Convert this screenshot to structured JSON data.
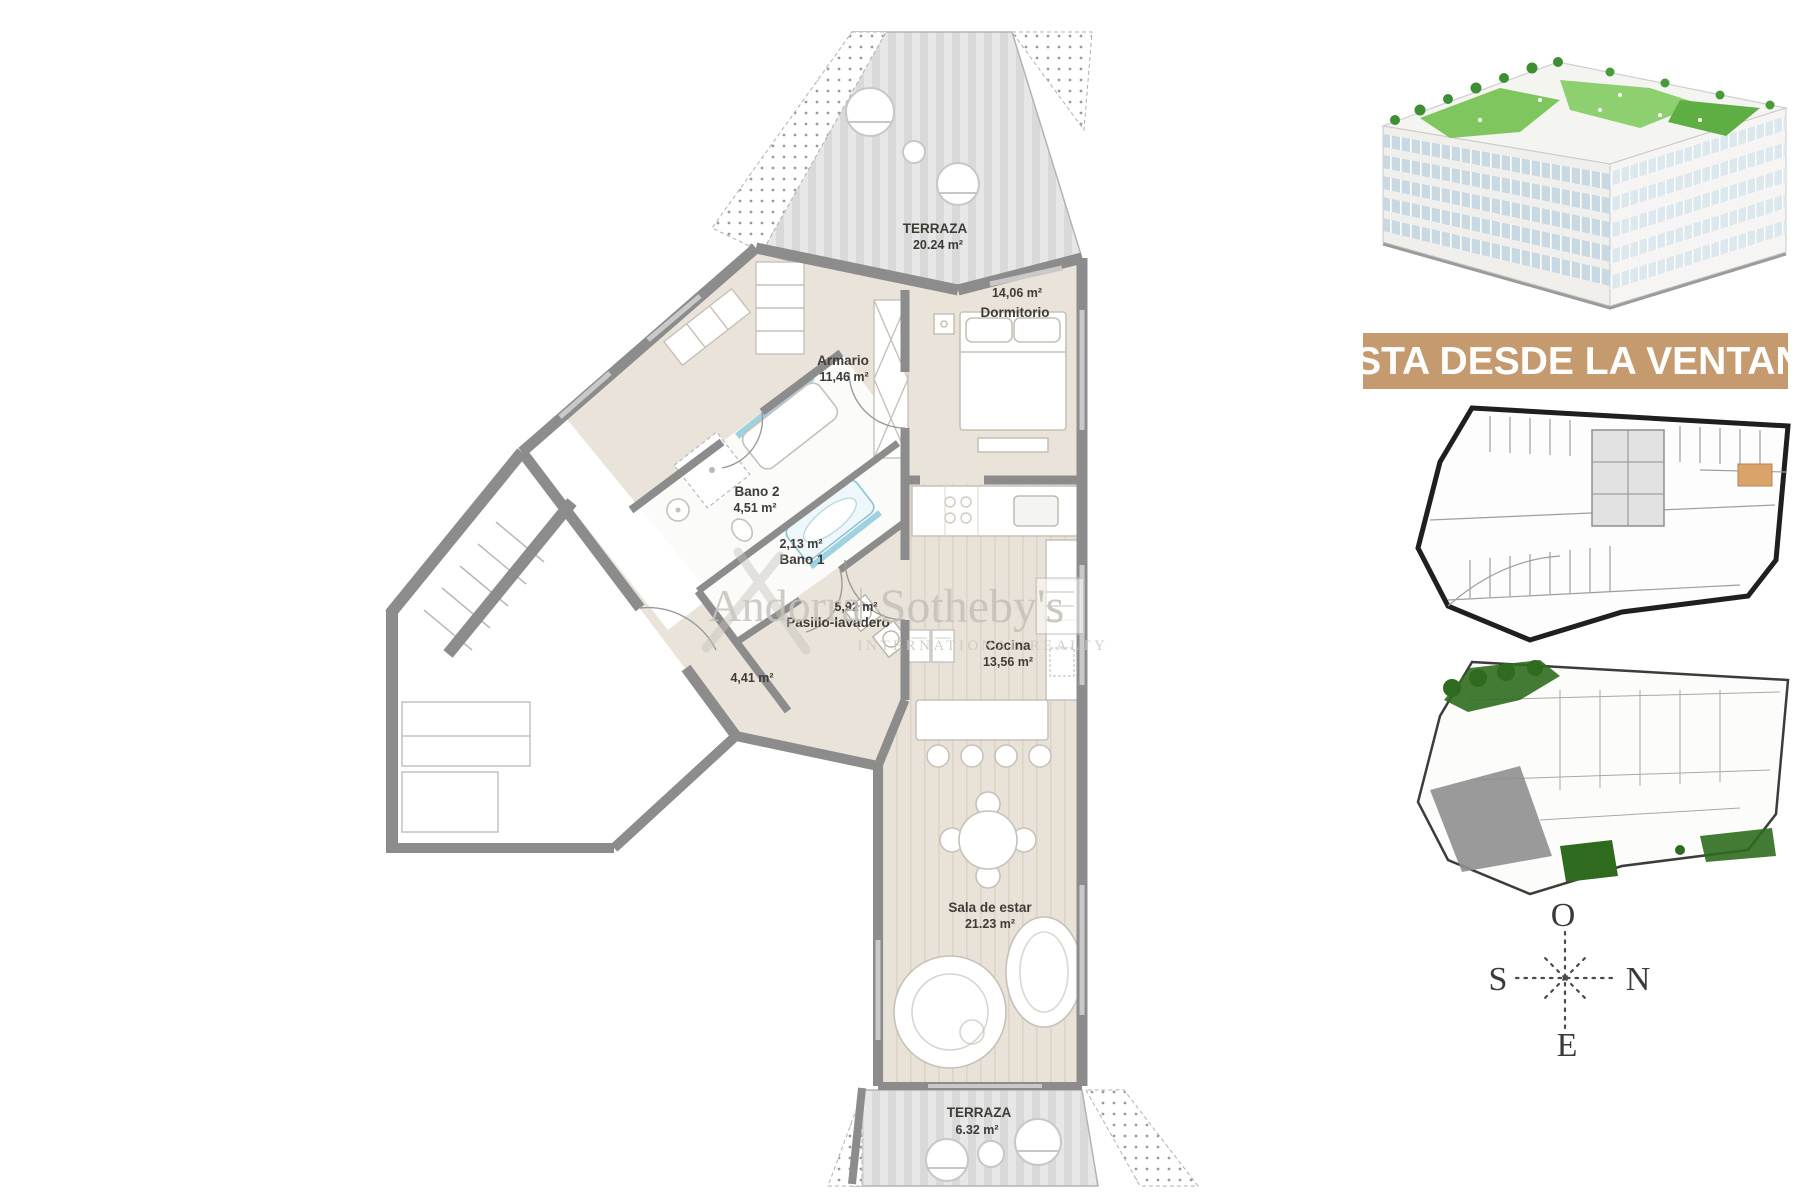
{
  "floorplan": {
    "rooms": {
      "terraza_top": {
        "name": "TERRAZA",
        "area": "20.24 m²"
      },
      "dormitorio": {
        "name": "Dormitorio",
        "area": "14,06 m²"
      },
      "armario": {
        "name": "Armario",
        "area": "11,46 m²"
      },
      "bano2": {
        "name": "Bano 2",
        "area": "4,51 m²"
      },
      "bano1": {
        "name": "Bano 1",
        "area": "2,13 m²"
      },
      "pasillo": {
        "name": "Pasillo-lavadero",
        "area": "5,92 m²"
      },
      "hall": {
        "area": "4,41 m²"
      },
      "cocina": {
        "name": "Cocina",
        "area": "13,56 m²"
      },
      "sala": {
        "name": "Sala de estar",
        "area": "21.23 m²"
      },
      "terraza_bottom": {
        "name": "TERRAZA",
        "area": "6.32 m²"
      }
    },
    "watermark": {
      "brand": "Andorra",
      "divider": "|",
      "brand2": "Sotheby's",
      "subtitle": "INTERNATIONAL REALTY"
    }
  },
  "sidebar": {
    "banner": {
      "label": "VISTA DESDE LA VENTANA"
    },
    "compass": {
      "top": "O",
      "right": "N",
      "left": "S",
      "bottom": "E"
    }
  },
  "colors": {
    "banner_bg": "#c49a6e",
    "unit_highlight": "#d9a36a",
    "garden_green": "#2f6b1e",
    "roof_green": "#72c14f",
    "wall_gray": "#8c8c8c"
  }
}
